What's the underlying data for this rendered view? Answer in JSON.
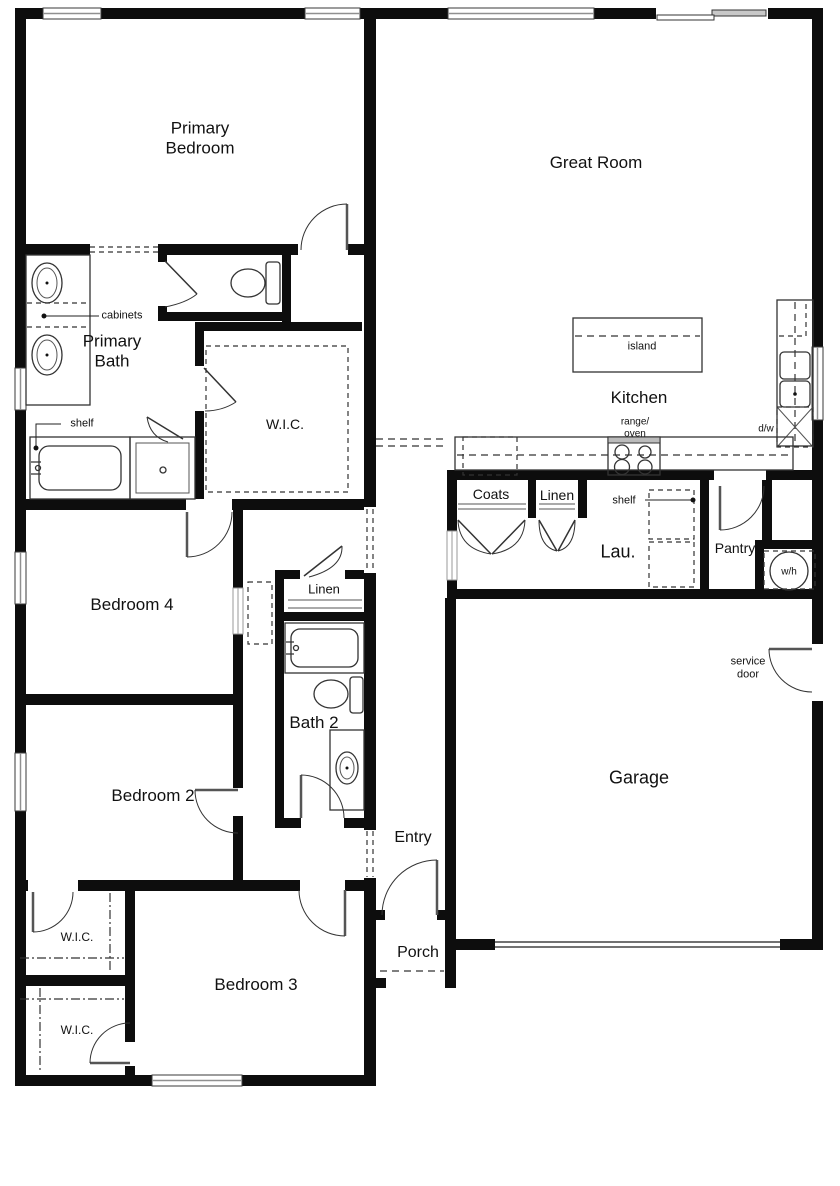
{
  "rooms": {
    "primary_bedroom": "Primary\nBedroom",
    "great_room": "Great Room",
    "primary_bath": "Primary\nBath",
    "kitchen": "Kitchen",
    "bedroom4": "Bedroom 4",
    "bedroom2": "Bedroom 2",
    "bedroom3": "Bedroom 3",
    "bath2": "Bath 2",
    "laundry": "Lau.",
    "pantry": "Pantry",
    "garage": "Garage",
    "entry": "Entry",
    "porch": "Porch"
  },
  "closets": {
    "wic_primary": "W.I.C.",
    "coats": "Coats",
    "linen_mud": "Linen",
    "linen_hall": "Linen",
    "wic_bedroom2": "W.I.C.",
    "wic_bedroom3": "W.I.C."
  },
  "annotations": {
    "cabinets": "cabinets",
    "shelf_bath": "shelf",
    "shelf_laundry": "shelf",
    "island": "island",
    "range_oven": "range/\noven",
    "dishwasher": "d/w",
    "water_heater": "w/h",
    "service_door": "service\ndoor"
  }
}
